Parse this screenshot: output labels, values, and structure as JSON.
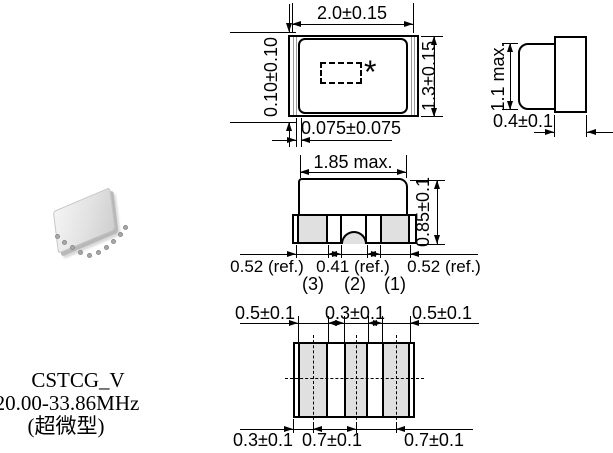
{
  "title_block": {
    "model": "CSTCG_V",
    "frequency_range": "20.00-33.86MHz",
    "note": "(超微型)"
  },
  "top_view": {
    "width": "2.0±0.15",
    "cap_offset_side": "0.10±0.10",
    "height": "1.3±0.15",
    "cap_offset_end": "0.075±0.075",
    "marking": "*"
  },
  "end_view": {
    "cap_height": "1.1 max.",
    "substrate_thickness": "0.4±0.1"
  },
  "front_view": {
    "cap_width": "1.85 max.",
    "height": "0.85±0.1",
    "pad_dims": [
      "0.52 (ref.)",
      "0.41 (ref.)",
      "0.52 (ref.)"
    ],
    "pin_labels": [
      "(3)",
      "(2)",
      "(1)"
    ]
  },
  "bottom_view": {
    "top_dims": [
      "0.5±0.1",
      "0.3±0.1",
      "0.5±0.1"
    ],
    "bottom_dims": [
      "0.3±0.1",
      "0.7±0.1",
      "0.7±0.1"
    ]
  },
  "colors": {
    "line": "#000000",
    "terminal_fill": "#e0e0e0",
    "background": "#ffffff"
  }
}
